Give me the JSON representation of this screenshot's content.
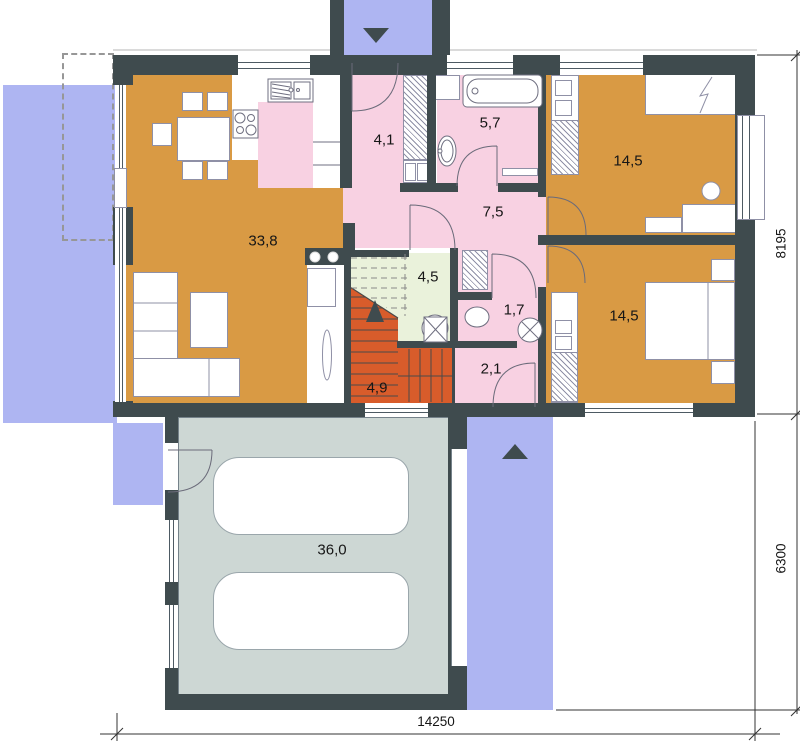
{
  "rooms": {
    "living": {
      "name": "living-room",
      "label": "33,8"
    },
    "entry": {
      "name": "entry-hall",
      "label": "4,1"
    },
    "bathroom": {
      "name": "bathroom",
      "label": "5,7"
    },
    "bedroom_top": {
      "name": "bedroom-top",
      "label": "14,5"
    },
    "hall": {
      "name": "hall",
      "label": "7,5"
    },
    "storage": {
      "name": "storage-room",
      "label": "4,5"
    },
    "wc": {
      "name": "wc",
      "label": "1,7"
    },
    "bedroom_bottom": {
      "name": "bedroom-bottom",
      "label": "14,5"
    },
    "vestibule": {
      "name": "back-vestibule",
      "label": "2,1"
    },
    "stairs": {
      "name": "staircase",
      "label": "4,9"
    },
    "garage": {
      "name": "garage",
      "label": "36,0"
    }
  },
  "dimensions": {
    "house_depth": "8195",
    "garage_depth": "6300",
    "total_width": "14250"
  },
  "colors": {
    "wall": "#3f4b4e",
    "wood_floor": "#d99a44",
    "tile_pink": "#f8d1e2",
    "storage_green": "#eaf2db",
    "stairs_red": "#d85c2b",
    "garage_gray": "#cdd7d4",
    "outdoor_blue": "#aeb5f2"
  },
  "icons": {
    "entrance_arrow": "triangle-down",
    "driveway_arrow": "triangle-up"
  }
}
